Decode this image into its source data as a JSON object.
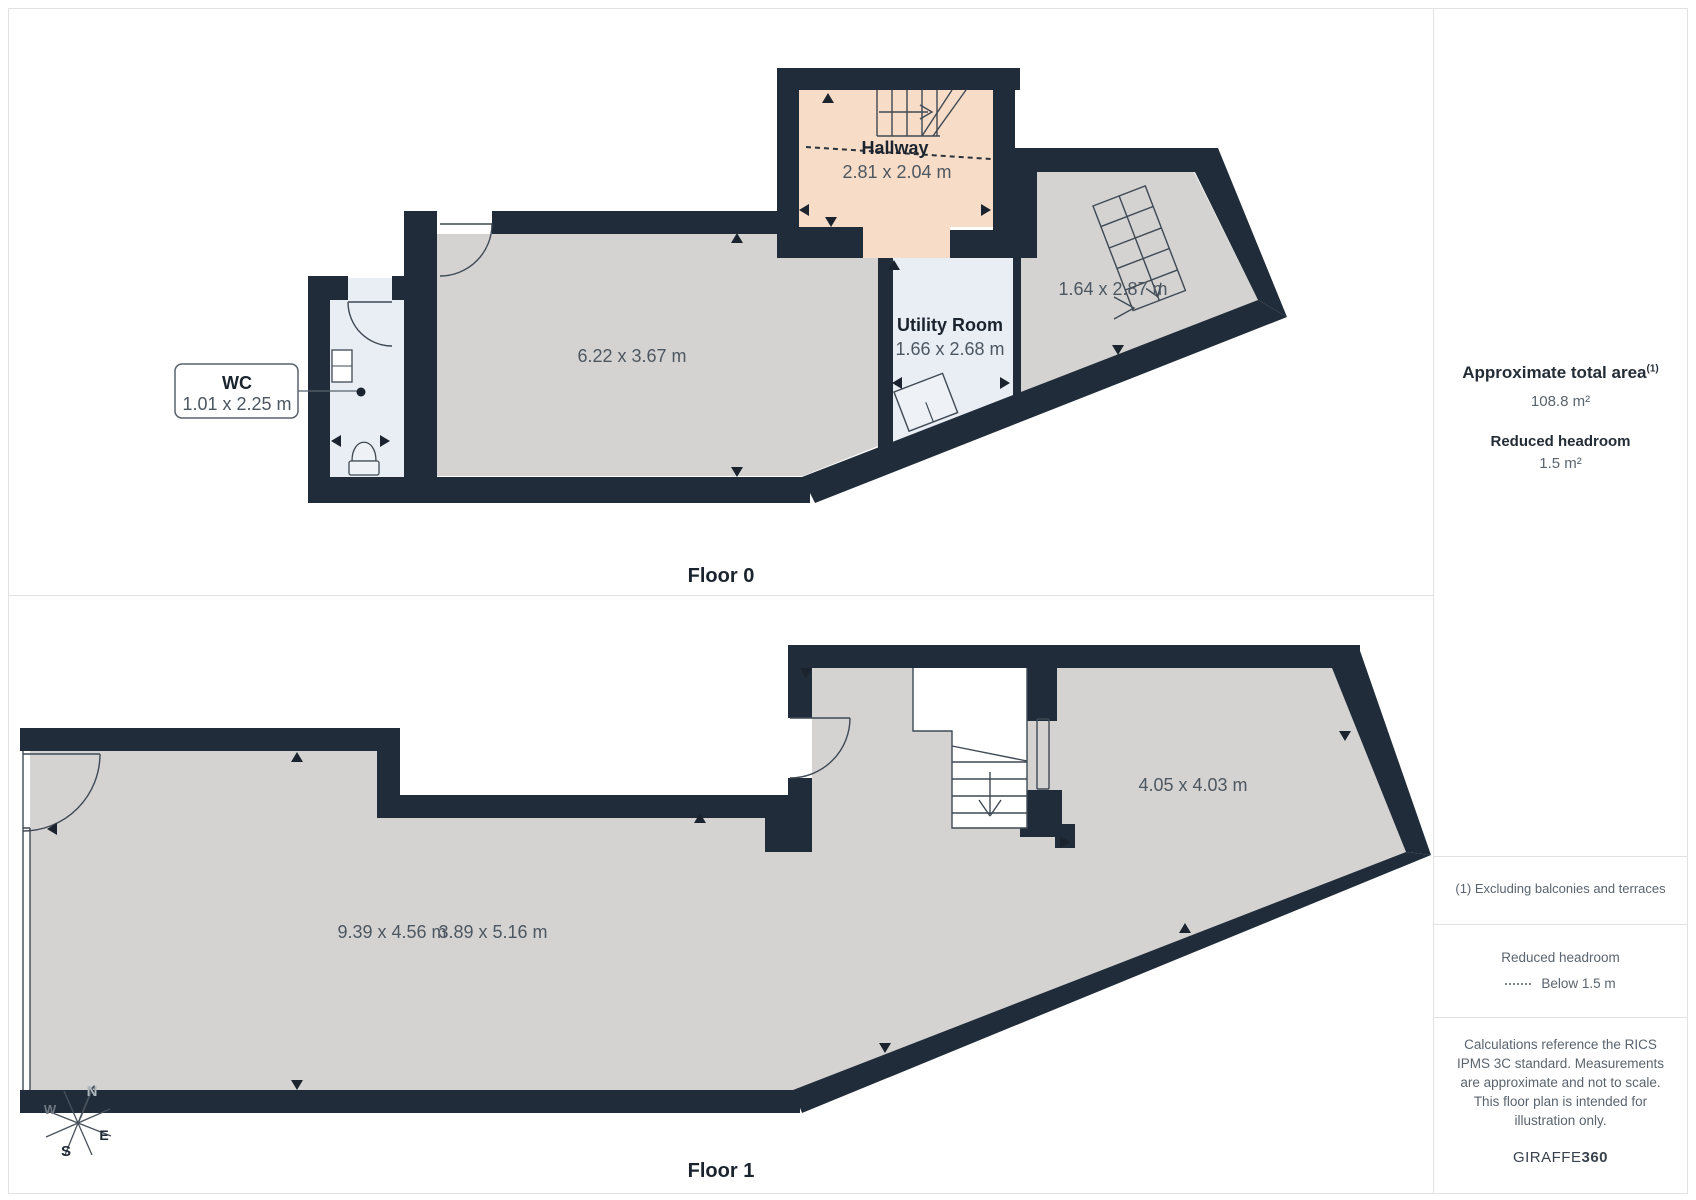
{
  "floor0": {
    "label": "Floor 0",
    "hallway_name": "Hallway",
    "hallway_dims": "2.81 x 2.04 m",
    "wc_name": "WC",
    "wc_dims": "1.01 x 2.25 m",
    "main_room_dims": "6.22 x 3.67 m",
    "utility_name": "Utility Room",
    "utility_dims": "1.66 x 2.68 m",
    "stair_area_dims": "1.64 x 2.87 m"
  },
  "floor1": {
    "label": "Floor 1",
    "room_a_dims": "9.39 x 4.56 m",
    "room_b_dims": "3.89 x 5.16 m",
    "room_c_dims": "4.05 x 4.03 m"
  },
  "compass": {
    "north": "N",
    "east": "E",
    "south": "S",
    "west": "W"
  },
  "sidebar": {
    "total_area_label": "Approximate total area",
    "total_area_footnote_marker": "(1)",
    "total_area_value": "108.8 m²",
    "reduced_headroom_label": "Reduced headroom",
    "reduced_headroom_value": "1.5 m²",
    "footnote": "(1) Excluding balconies and terraces",
    "legend_title": "Reduced headroom",
    "legend_item": "Below 1.5 m",
    "disclaimer": "Calculations reference the RICS IPMS 3C standard. Measurements are approximate and not to scale. This floor plan is intended for illustration only.",
    "brand_regular": "GIRAFFE",
    "brand_bold": "360"
  },
  "colors": {
    "wall": "#202c39",
    "floor": "#d4d3d1",
    "hallway": "#f7dcc7",
    "wet_room": "#e9edf4",
    "divider": "#e2e2e2",
    "dims_text": "#4d5761",
    "name_text": "#1b242e"
  }
}
